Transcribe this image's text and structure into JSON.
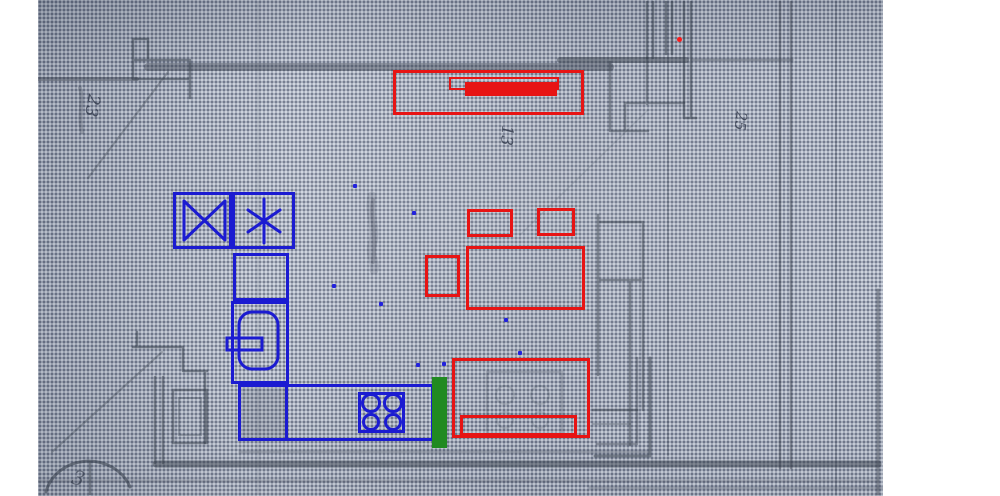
{
  "image": {
    "width": 1000,
    "height": 496,
    "photo_area": {
      "x": 38,
      "y": 0,
      "w": 845,
      "h": 496
    }
  },
  "palette": {
    "annotation_blue": "#1b1bd1",
    "annotation_red": "#e71414",
    "annotation_green": "#218a21",
    "dot_blue": "#2222dd",
    "dot_red": "#ff1a1a",
    "pencil": "#39414e",
    "paper": "#aab1c0"
  },
  "handwriting": {
    "label_23": "23",
    "label_13": "13",
    "label_25": "25",
    "label_3": "3"
  },
  "annotations": {
    "boxes": [
      {
        "name": "bbox-fridge-cell",
        "color": "annotation_blue",
        "x": 173,
        "y": 192,
        "w": 59,
        "h": 57,
        "bw": 3
      },
      {
        "name": "bbox-freezer-cell",
        "color": "annotation_blue",
        "x": 232,
        "y": 192,
        "w": 63,
        "h": 57,
        "bw": 3
      },
      {
        "name": "bbox-upper-cabinet",
        "color": "annotation_blue",
        "x": 233,
        "y": 253,
        "w": 56,
        "h": 48,
        "bw": 3
      },
      {
        "name": "bbox-boiler",
        "color": "annotation_blue",
        "x": 231,
        "y": 301,
        "w": 58,
        "h": 83,
        "bw": 3
      },
      {
        "name": "bbox-counter",
        "color": "annotation_blue",
        "x": 238,
        "y": 384,
        "w": 196,
        "h": 57,
        "bw": 3
      },
      {
        "name": "bbox-sink-cabinet",
        "color": "annotation_blue",
        "x": 238,
        "y": 384,
        "w": 50,
        "h": 57,
        "bw": 3
      },
      {
        "name": "bbox-cooktop-symbol",
        "color": "annotation_blue",
        "x": 358,
        "y": 392,
        "w": 47,
        "h": 41,
        "bw": 3
      },
      {
        "name": "bbox-window",
        "color": "annotation_red",
        "x": 393,
        "y": 70,
        "w": 191,
        "h": 45,
        "bw": 3
      },
      {
        "name": "bbox-window-sill",
        "color": "annotation_red",
        "x": 449,
        "y": 77,
        "w": 110,
        "h": 13,
        "bw": 2
      },
      {
        "name": "bbox-small-left",
        "color": "annotation_red",
        "x": 467,
        "y": 209,
        "w": 46,
        "h": 28,
        "bw": 3
      },
      {
        "name": "bbox-small-right",
        "color": "annotation_red",
        "x": 537,
        "y": 208,
        "w": 38,
        "h": 28,
        "bw": 3
      },
      {
        "name": "bbox-chair",
        "color": "annotation_red",
        "x": 425,
        "y": 255,
        "w": 35,
        "h": 42,
        "bw": 3
      },
      {
        "name": "bbox-table",
        "color": "annotation_red",
        "x": 466,
        "y": 246,
        "w": 119,
        "h": 64,
        "bw": 3
      },
      {
        "name": "bbox-stove-area",
        "color": "annotation_red",
        "x": 452,
        "y": 358,
        "w": 138,
        "h": 80,
        "bw": 3
      },
      {
        "name": "bbox-stove-front",
        "color": "annotation_red",
        "x": 460,
        "y": 415,
        "w": 117,
        "h": 21,
        "bw": 3
      }
    ],
    "filled": [
      {
        "name": "window-highlight-bar",
        "color": "annotation_red",
        "x": 465,
        "y": 82,
        "w": 92,
        "h": 14,
        "round": 0
      },
      {
        "name": "door-marker-bar",
        "color": "annotation_green",
        "x": 432,
        "y": 377,
        "w": 15,
        "h": 71,
        "round": 0
      },
      {
        "name": "red-dot-marker",
        "color": "dot_red",
        "x": 677,
        "y": 37,
        "w": 5,
        "h": 5,
        "round": 3
      }
    ],
    "dots": [
      {
        "name": "point-marker",
        "x": 353,
        "y": 184
      },
      {
        "name": "point-marker",
        "x": 412,
        "y": 211
      },
      {
        "name": "point-marker",
        "x": 332,
        "y": 284
      },
      {
        "name": "point-marker",
        "x": 379,
        "y": 302
      },
      {
        "name": "point-marker",
        "x": 504,
        "y": 318
      },
      {
        "name": "point-marker",
        "x": 518,
        "y": 351
      },
      {
        "name": "point-marker",
        "x": 416,
        "y": 363
      },
      {
        "name": "point-marker",
        "x": 442,
        "y": 362
      }
    ]
  }
}
